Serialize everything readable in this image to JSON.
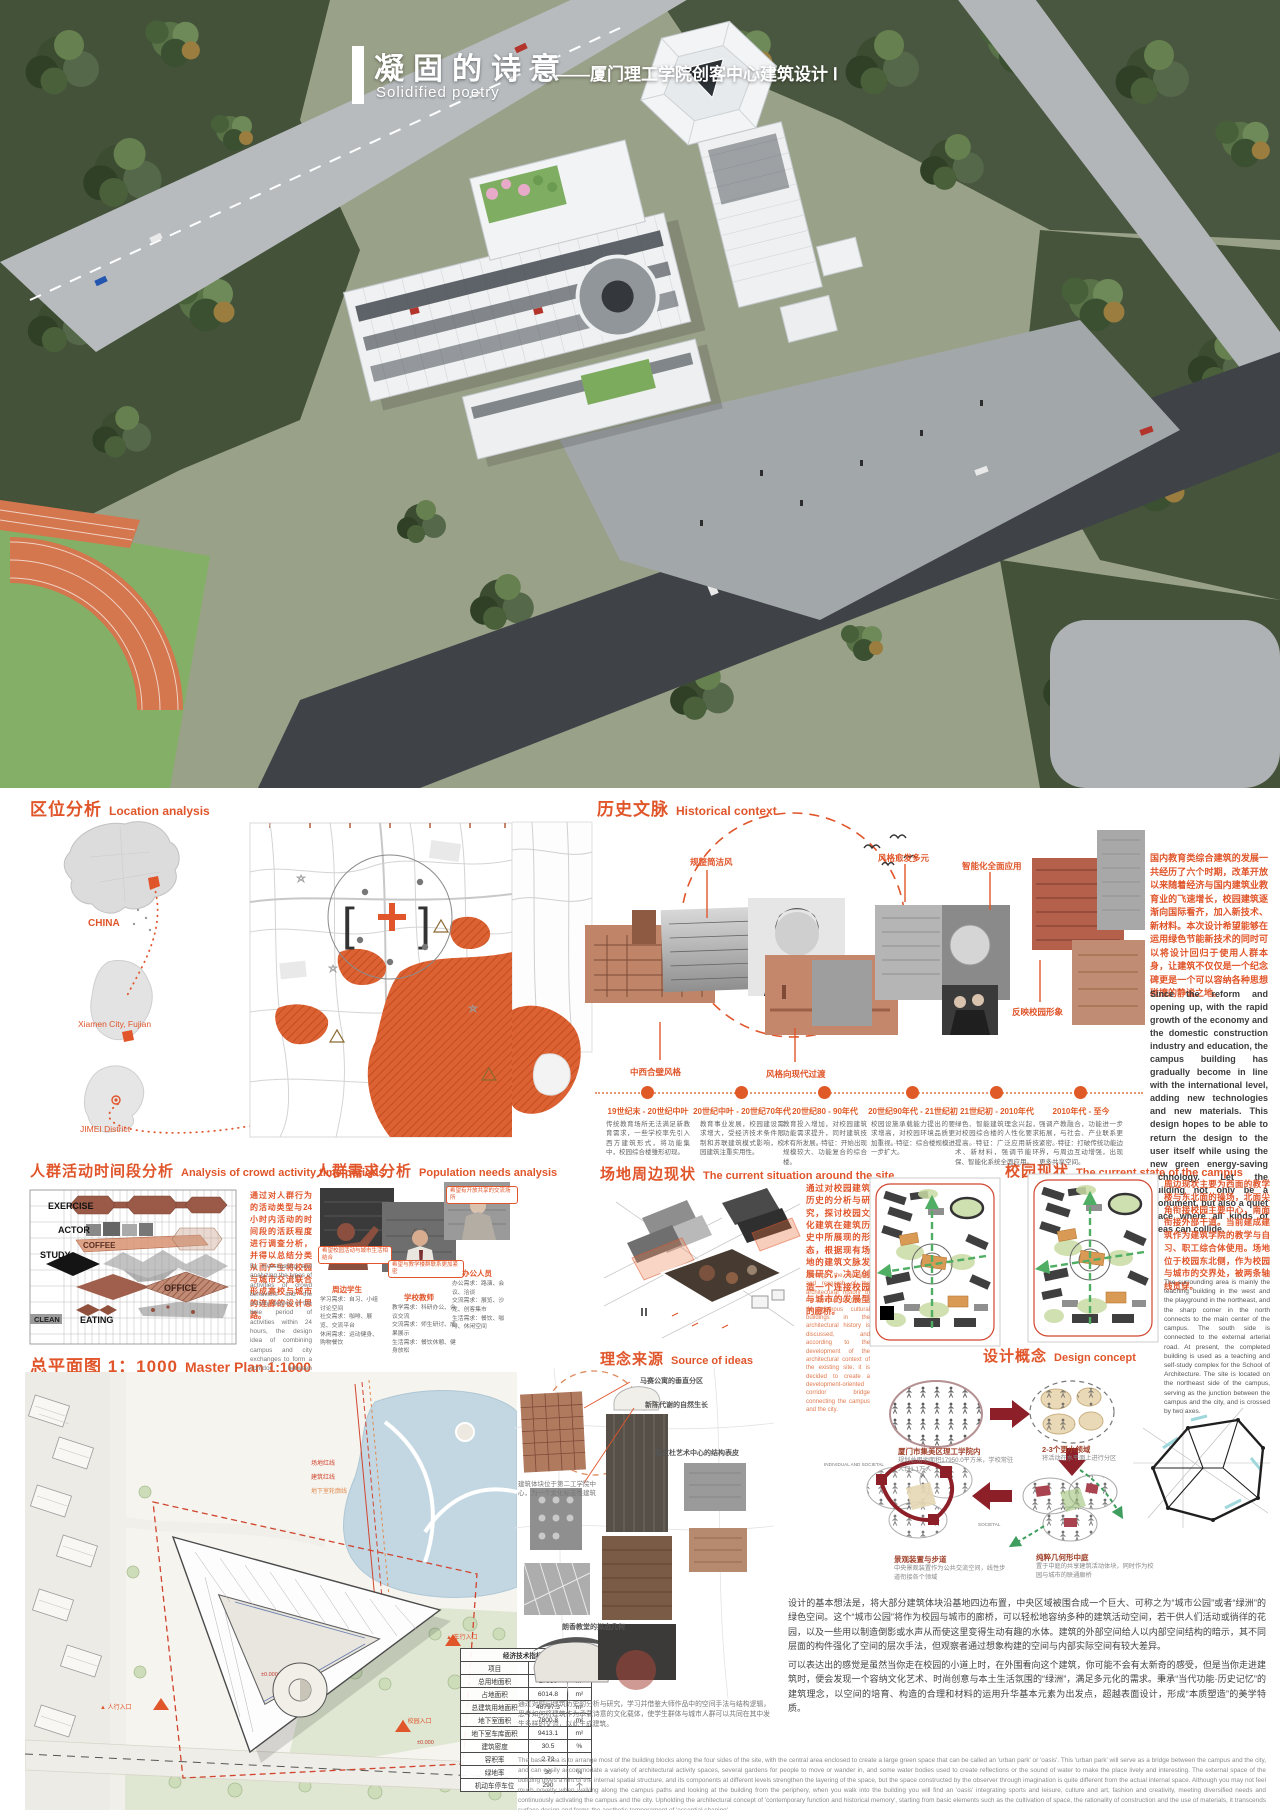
{
  "meta": {
    "accent": "#e0552a",
    "map_orange": "#dd6233",
    "diagram_red": "#8c1f28"
  },
  "header": {
    "title_cn": "凝固的诗意",
    "title_en": "Solidified poetry",
    "subtitle": "——厦门理工学院创客中心建筑设计 Ⅰ"
  },
  "location": {
    "title_cn": "区位分析",
    "title_en": "Location analysis",
    "china": "CHINA",
    "xiamen": "Xiamen City, Fujian",
    "jimei": "JIMEI District"
  },
  "history": {
    "title_cn": "历史文脉",
    "title_en": "Historical context",
    "ann_top": [
      "规整简洁风",
      "风格愈发多元",
      "智能化全面应用"
    ],
    "ann_bottom": [
      "中西合璧风格",
      "风格向现代过渡",
      "反映校园形象"
    ],
    "intro_cn": "国内教育类综合建筑的发展一共经历了六个时期，改革开放以来随着经济与国内建筑业教育业的飞速增长，校园建筑逐渐向国际看齐，加入新技术、新材料。本次设计希望能够在运用绿色节能新技术的同时可以将设计回归于使用人群本身，让建筑不仅仅是一个纪念碑更是一个可以容纳各种思想碰撞的静谧之地。",
    "intro_en": "Since the reform and opening up, with the rapid growth of the economy and the domestic construction industry and education, the campus building has gradually become in line with the international level, adding new technologies and new materials. This design hopes to be able to return the design to the user itself while using the new green energy-saving technology. Let the building not only be a monument, but also a quiet place where all kinds of ideas can collide.",
    "timeline": [
      {
        "period": "19世纪末 - 20世纪中叶",
        "desc": "传统教育场所无法满足新教育需求，一些学校率先引入西方建筑形式，将功能集中，校园综合楼雏形初现。"
      },
      {
        "period": "20世纪中叶 - 20世纪70年代",
        "desc": "教育事业发展，校园建设需求增大，受经济技术条件限制和苏联建筑模式影响，校园建筑注重实用性。"
      },
      {
        "period": "20世纪80 - 90年代",
        "desc": "教育投入增加，对校园建筑功能需求提升，同时建筑技术有所发展。·特征：开始出现规模较大、功能复合的综合楼。"
      },
      {
        "period": "20世纪90年代 - 21世纪初",
        "desc": "校园设施承载能力提出的要求增高，对校园环境品质更加重视。·特征：综合楼规模进一步扩大。"
      },
      {
        "period": "21世纪初 - 2010年代",
        "desc": "绿色、智能建筑理念兴起，对校园综合楼的人性化要求提高。·特征：广泛应用新技术、新材料，强调节能环保、智能化系统全面应用。"
      },
      {
        "period": "2010年代 - 至今",
        "desc": "强调产教融合，功能进一步拓展，与社会、产业联系更紧密。·特征：打破传统功能边界，与周边互动增强，出现更多共享空间。"
      }
    ]
  },
  "activity": {
    "title_cn": "人群活动时间段分析",
    "title_en": "Analysis of crowd activity time periods",
    "rows": [
      "EXERCISE",
      "ACTOR",
      "COFFEE",
      "STUDY",
      "OFFICE",
      "EATING",
      "CLEAN"
    ],
    "text_cn": "通过对人群行为的活动类型与24小时内活动的时间段的活跃程度进行调查分析，并得以总结分类从而产生将校园与城市交流联合形成高校与城市的连廊的设计思路。",
    "text_en": "By investigating and analyzing the types of activities of crowd behaviors and the activity degree of the time period of activities within 24 hours, the design idea of combining campus and city exchanges to form a corridor between universities and cities was generated."
  },
  "needs": {
    "title_cn": "人群需求分析",
    "title_en": "Population needs analysis",
    "groups": [
      {
        "label": "周边学生",
        "lines": [
          "学习需求：自习、小组讨论空间",
          "社交需求：咖啡、展览、交流平台",
          "休闲需求：运动健身、购物餐饮"
        ]
      },
      {
        "label": "学校教师",
        "lines": [
          "教学需求：科研办公、会议交流",
          "交流需求：师生研讨、成果展示",
          "生活需求：餐饮休憩、健身放松"
        ]
      },
      {
        "label": "办公人员",
        "lines": [
          "办公需求：路演、会议、洽谈",
          "交流需求：展览、沙龙、创客集市",
          "生活需求：餐饮、咖啡、休闲空间"
        ]
      }
    ],
    "bubbles": [
      "希望校园活动与城市生活相结合",
      "希望与教学楼群联系更加紧密",
      "希望有开放共享的交流场所"
    ]
  },
  "site": {
    "title_cn": "场地周边现状",
    "title_en": "The current situation around the site",
    "text_cn": "通过对校园建筑历史的分析与研究，探讨校园文化建筑在建筑历史中所展现的形态，根据现有场地的建筑文脉发展研究，决定创造一个连接校园与城市的发展型的廊桥。",
    "text_en": "Through the analysis and research of the architectural history of the campus, the form of the campus cultural buildings in the architectural history is discussed, and according to the development of the architectural context of the existing site, it is decided to create a development-oriented corridor bridge connecting the campus and the city."
  },
  "campus": {
    "title_cn": "校园现状",
    "title_en": "The current state of the campus",
    "text_cn": "周边现状主要为西面的教学楼与东北面的操场，北面尖角衔接校园主要中心，南面衔接外部干道。当前建成建筑作为建筑学院的教学与自习、职工综合体使用。场地位于校园东北侧，作为校园与城市的交界处，被两条轴线贯穿。",
    "text_en": "The surrounding area is mainly the teaching building in the west and the playground in the northeast, and the sharp corner in the north connects to the main center of the campus. The south side is connected to the external arterial road. At present, the completed building is used as a teaching and self-study complex for the School of Architecture. The site is located on the northeast side of the campus, serving as the junction between the campus and the city, and is crossed by two axes."
  },
  "masterplan": {
    "title_cn": "总平面图 1：1000",
    "title_en": "Master Plan 1:1000",
    "labels": {
      "site_line": "场地红线",
      "building_line": "建筑红线",
      "basement_line": "地下室轮廓线",
      "vehicle_entry": "▲ 车行入口",
      "campus_entry": "▲ 校园入口",
      "walk_entry": "▲ 人行入口",
      "level": "±0.000"
    },
    "table": {
      "title": "经济技术指标表",
      "headers": [
        "项目",
        "数值",
        "单位"
      ],
      "rows": [
        [
          "总用地面积",
          "17950",
          "m²"
        ],
        [
          "占地面积",
          "6014.8",
          "m²"
        ],
        [
          "总建筑用地面积",
          "48797.3",
          "m²"
        ],
        [
          "地下室面积",
          "7800.8",
          "m²"
        ],
        [
          "地下室车库面积",
          "9413.1",
          "m²"
        ],
        [
          "建筑密度",
          "30.5",
          "%"
        ],
        [
          "容积率",
          "2.72",
          ""
        ],
        [
          "绿地率",
          "30",
          "%"
        ],
        [
          "机动车停车位",
          "290",
          "个"
        ]
      ]
    }
  },
  "ideas": {
    "title_cn": "理念来源",
    "title_en": "Source of ideas",
    "labels": [
      "马赛公寓的垂直分区",
      "新陈代谢的自然生长",
      "蓬皮杜艺术中心的结构表皮",
      "朗香教堂的拟态几何"
    ],
    "note": "建筑体块位于第二工学院中心，为一个文化标志性建筑",
    "para": "通过对校园建筑历史的分析与研究，学习并借鉴大师作品中的空间手法与结构逻辑，思考如何将建筑作为承载诗意的文化载体，使学生群体与城市人群可以共同在其中发生多样的交流，以此生成建筑。"
  },
  "concept": {
    "title_cn": "设计概念",
    "title_en": "Design concept",
    "steps": [
      {
        "label": "厦门市集美区理工学院内",
        "sub": "规划总用地面积17950.0平方米，学校常驻人口1.1万人"
      },
      {
        "label": "2-3个更小领域",
        "sub": "将活动在水平面上进行分区"
      },
      {
        "label": "纯粹几何形中庭",
        "sub": "置于中庭的共享建筑活动体块，同时作为校园与城市的联通廊桥"
      },
      {
        "label": "景观装置与步道",
        "sub": "中央景观装置作为公共交流空间，线性步道衔接各个领域"
      }
    ],
    "tags": {
      "t1": "INDIVIDUAL AND SOCIETAL",
      "t2": "SOCIETAL"
    },
    "para1": "设计的基本想法是，将大部分建筑体块沿基地四边布置，中央区域被围合成一个巨大、可称之为“城市公园”或者“绿洲”的绿色空间。这个“城市公园”将作为校园与城市的廊桥，可以轻松地容纳多种的建筑活动空间，若干供人们活动或徜徉的花园，以及一些用以制造倒影或水声从而使这里变得生动有趣的水体。建筑的外部空间给人以内部空间结构的暗示，其不同层面的构件强化了空间的层次手法，但观察者通过想象构建的空间与内部实际空间有较大差异。",
    "para2": "可以表达出的感觉是虽然当你走在校园的小道上时，在外围看向这个建筑，你可能不会有太新奇的感受，但是当你走进建筑时，便会发现一个容纳文化艺术、时尚创意与本土生活氛围的“绿洲”，满足多元化的需求。秉承“当代功能·历史记忆”的建筑理念，以空间的培育、构造的合理和材料的运用升华基本元素为出发点，超越表面设计，形成“本质塑造”的美学特质。",
    "fine_print_en": "The basic idea is to arrange most of the building blocks along the four sides of the site, with the central area enclosed to create a large green space that can be called an 'urban park' or 'oasis'. This 'urban park' will serve as a bridge between the campus and the city, and can easily accommodate a variety of architectural activity spaces, several gardens for people to move or wander in, and some water bodies used to create reflections or the sound of water to make the place lively and interesting. The external space of the building gives a hint of the internal spatial structure, and its components at different levels strengthen the layering of the space, but the space constructed by the observer through imagination is quite different from the actual internal space. Although you may not feel much novelty when walking along the campus paths and looking at the building from the periphery, when you walk into the building you will find an 'oasis' integrating sports and leisure, culture and art, fashion and creativity, meeting diversified needs and continuously activating the campus and the city. Upholding the architectural concept of 'contemporary function and historical memory', starting from basic elements such as the cultivation of space, the rationality of construction and the use of materials, it transcends surface design and forms the aesthetic temperament of 'essential shaping'."
  }
}
